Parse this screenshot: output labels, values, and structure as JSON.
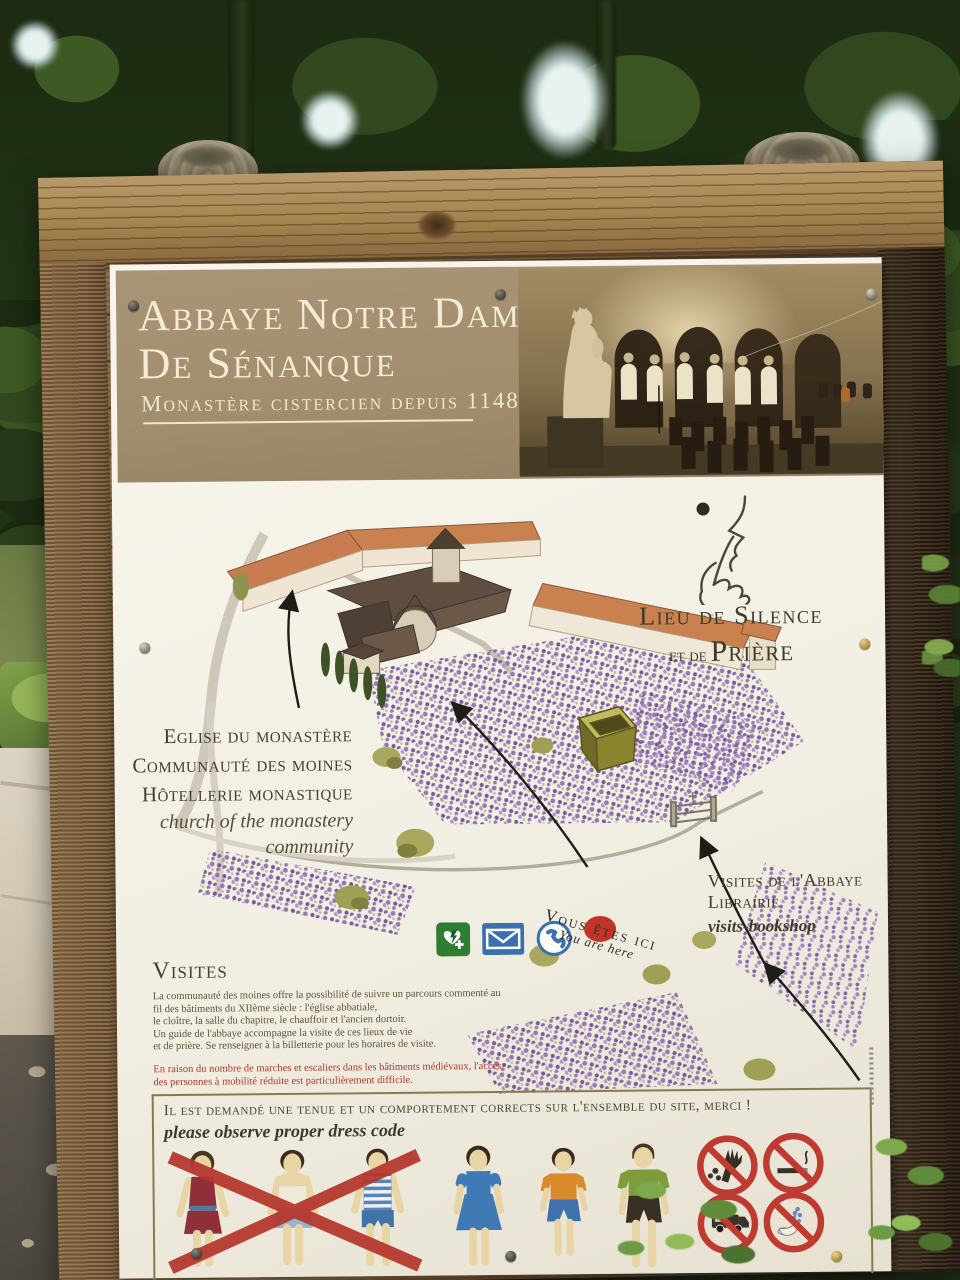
{
  "sign": {
    "header": {
      "title_line1": "Abbaye Notre Dame",
      "title_line2": "De Sénanque",
      "subtitle": "Monastère cistercien depuis 1148"
    },
    "silence": {
      "line1": "Lieu de Silence",
      "line2_small": "et de",
      "line2_large": "Prière",
      "icon": "finger-on-lips-icon"
    },
    "map": {
      "labels_left": [
        "Eglise du monastère",
        "Communauté des moines",
        "Hôtellerie monastique"
      ],
      "labels_left_en": [
        "church of the monastery",
        "community"
      ],
      "you_are_here": {
        "fr": "Vous êtes ici",
        "en": "You are here",
        "marker_color": "#c23329"
      },
      "visits": {
        "line1": "Visites de l'Abbaye",
        "line2": "Librairie",
        "en": "visits-bookshop"
      },
      "amenity_icons": [
        "defibrillator-icon",
        "mail-icon",
        "phone-icon"
      ]
    },
    "visites": {
      "heading": "Visites",
      "body": [
        "La communauté des moines offre la possibilité de suivre un parcours commenté au",
        "fil des bâtiments du XIIème siècle : l'église abbatiale,",
        "le cloître, la salle du chapitre, le chauffoir et l'ancien dortoir.",
        "Un guide de l'abbaye accompagne la visite de ces lieux de vie",
        "et de prière. Se renseigner à la billetterie pour les horaires de visite."
      ],
      "warning": [
        "En raison du nombre de marches et escaliers dans les bâtiments médiévaux, l'accès",
        "des personnes à mobilité réduite est particulièrement difficile."
      ]
    },
    "dress_code": {
      "fr": "Il est demandé une tenue et un comportement corrects sur l'ensemble du site, merci !",
      "en": "please observe proper dress code",
      "not_allowed_figures": [
        "woman-short-skirt",
        "woman-strapless-top",
        "man-tank-top"
      ],
      "allowed_figures": [
        "woman-knee-dress",
        "person-tshirt-knee-shorts",
        "man-tshirt-knee-shorts"
      ],
      "prohibition_icons": [
        "no-flower-picking-icon",
        "no-smoking-icon",
        "no-motorhome-icon",
        "no-lavender-cutting-icon"
      ]
    },
    "colors": {
      "band": "#a29070",
      "band_text": "#f2ebd7",
      "ink": "#3e3a2c",
      "body_text": "#5d5334",
      "warning": "#ac392d",
      "prohibition_red": "#bf3a31",
      "cross_red": "#b5352c",
      "lavender": "#8f6fae",
      "roof_orange": "#c77d4f",
      "panel": "#f3f0e6",
      "wood_light": "#ab8c5c",
      "wood_dark": "#3c2f23"
    }
  }
}
